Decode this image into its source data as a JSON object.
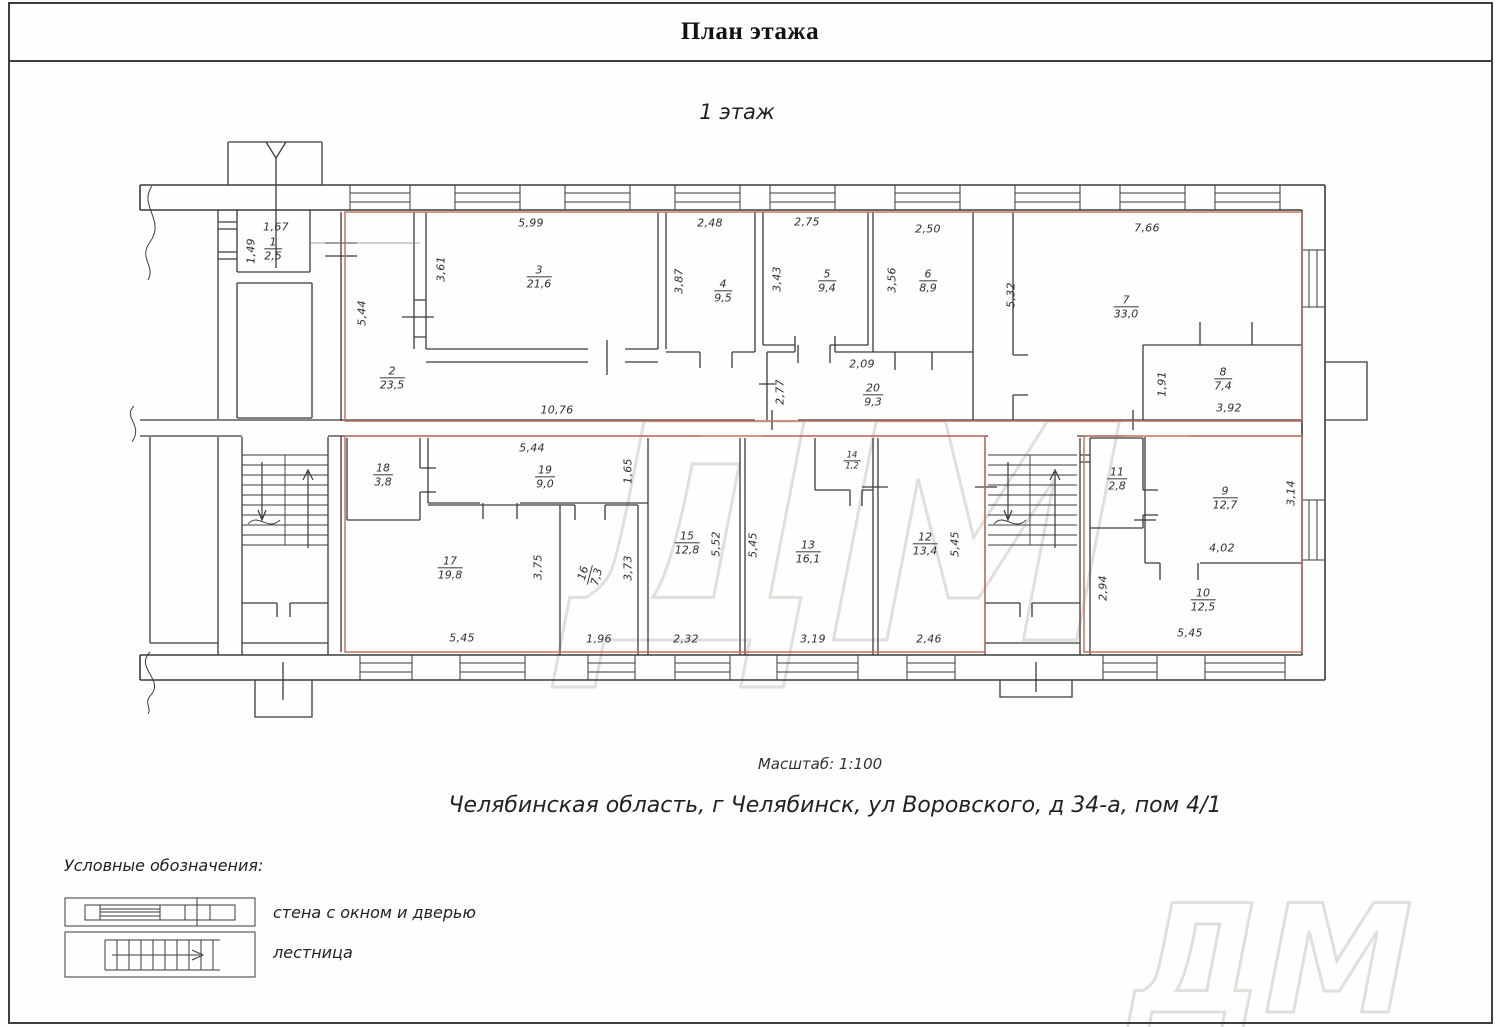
{
  "page": {
    "title": "План этажа",
    "floor_label": "1 этаж",
    "scale_label": "Масштаб: 1:100",
    "address": "Челябинская область, г Челябинск, ул Воровского, д 34-а, пом 4/1",
    "watermark": "ДМ"
  },
  "legend": {
    "title": "Условные обозначения:",
    "items": [
      {
        "label": "стена с окном и дверью"
      },
      {
        "label": "лестница"
      }
    ]
  },
  "boundary_color": "#c5705f",
  "rooms": [
    {
      "number": "1",
      "area": "2,5"
    },
    {
      "number": "2",
      "area": "23,5"
    },
    {
      "number": "3",
      "area": "21,6"
    },
    {
      "number": "4",
      "area": "9,5"
    },
    {
      "number": "5",
      "area": "9,4"
    },
    {
      "number": "6",
      "area": "8,9"
    },
    {
      "number": "7",
      "area": "33,0"
    },
    {
      "number": "8",
      "area": "7,4"
    },
    {
      "number": "9",
      "area": "12,7"
    },
    {
      "number": "10",
      "area": "12,5"
    },
    {
      "number": "11",
      "area": "2,8"
    },
    {
      "number": "12",
      "area": "13,4"
    },
    {
      "number": "13",
      "area": "16,1"
    },
    {
      "number": "14",
      "area": "1,2"
    },
    {
      "number": "15",
      "area": "12,8"
    },
    {
      "number": "16",
      "area": "7,3"
    },
    {
      "number": "17",
      "area": "19,8"
    },
    {
      "number": "18",
      "area": "3,8"
    },
    {
      "number": "19",
      "area": "9,0"
    },
    {
      "number": "20",
      "area": "9,3"
    }
  ],
  "dimensions": [
    {
      "id": "d1",
      "value": "1,67"
    },
    {
      "id": "d2",
      "value": "1,49"
    },
    {
      "id": "d3",
      "value": "5,44"
    },
    {
      "id": "d4",
      "value": "5,99"
    },
    {
      "id": "d5",
      "value": "3,61"
    },
    {
      "id": "d6",
      "value": "10,76"
    },
    {
      "id": "d7",
      "value": "3,87"
    },
    {
      "id": "d8",
      "value": "2,48"
    },
    {
      "id": "d9",
      "value": "3,43"
    },
    {
      "id": "d10",
      "value": "2,75"
    },
    {
      "id": "d11",
      "value": "3,56"
    },
    {
      "id": "d12",
      "value": "2,50"
    },
    {
      "id": "d13",
      "value": "5,32"
    },
    {
      "id": "d14",
      "value": "7,66"
    },
    {
      "id": "d15",
      "value": "2,09"
    },
    {
      "id": "d16",
      "value": "2,77"
    },
    {
      "id": "d17",
      "value": "1,91"
    },
    {
      "id": "d18",
      "value": "3,92"
    },
    {
      "id": "d19",
      "value": "5,44"
    },
    {
      "id": "d20",
      "value": "1,65"
    },
    {
      "id": "d21",
      "value": "3,75"
    },
    {
      "id": "d22",
      "value": "3,73"
    },
    {
      "id": "d23",
      "value": "5,52"
    },
    {
      "id": "d24",
      "value": "5,45"
    },
    {
      "id": "d25",
      "value": "5,45"
    },
    {
      "id": "d26",
      "value": "5,45"
    },
    {
      "id": "d27",
      "value": "1,96"
    },
    {
      "id": "d28",
      "value": "2,32"
    },
    {
      "id": "d29",
      "value": "3,19"
    },
    {
      "id": "d30",
      "value": "2,46"
    },
    {
      "id": "d31",
      "value": "3,14"
    },
    {
      "id": "d32",
      "value": "4,02"
    },
    {
      "id": "d33",
      "value": "2,94"
    },
    {
      "id": "d34",
      "value": "5,45"
    }
  ]
}
